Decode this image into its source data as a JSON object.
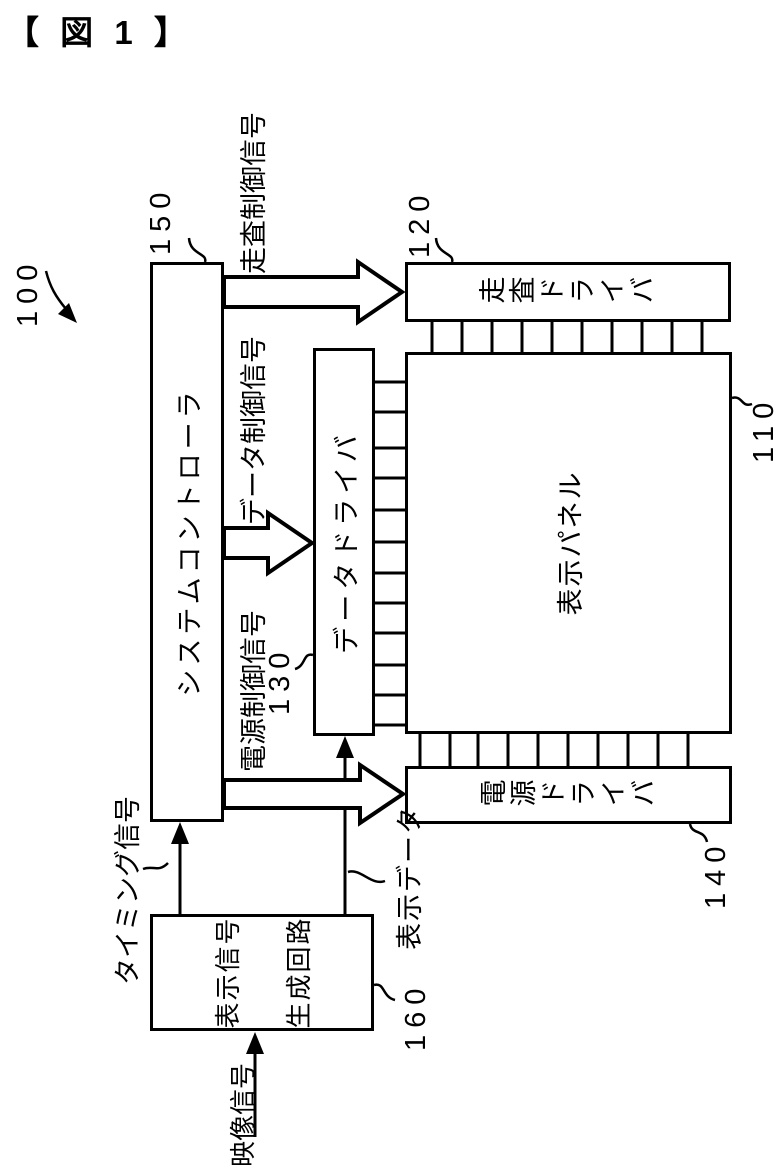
{
  "figure": {
    "title": "【 図 1 】",
    "overall_ref": "100",
    "blocks": {
      "system_controller": {
        "label": "システムコントローラ",
        "ref": "150"
      },
      "scan_driver": {
        "label": "走査ドライバ",
        "ref": "120"
      },
      "display_panel": {
        "label": "表示パネル",
        "ref": "110"
      },
      "data_driver": {
        "label": "データドライバ",
        "ref": "130"
      },
      "power_driver": {
        "label": "電源ドライバ",
        "ref": "140"
      },
      "display_signal_generator": {
        "label_line1": "表示信号",
        "label_line2": "生成回路",
        "ref": "160"
      }
    },
    "signals": {
      "scan_control": "走査制御信号",
      "data_control": "データ制御信号",
      "power_control": "電源制御信号",
      "timing": "タイミング信号",
      "display_data": "表示データ",
      "video": "映像信号"
    },
    "colors": {
      "ink": "#000000",
      "paper": "#ffffff"
    }
  }
}
